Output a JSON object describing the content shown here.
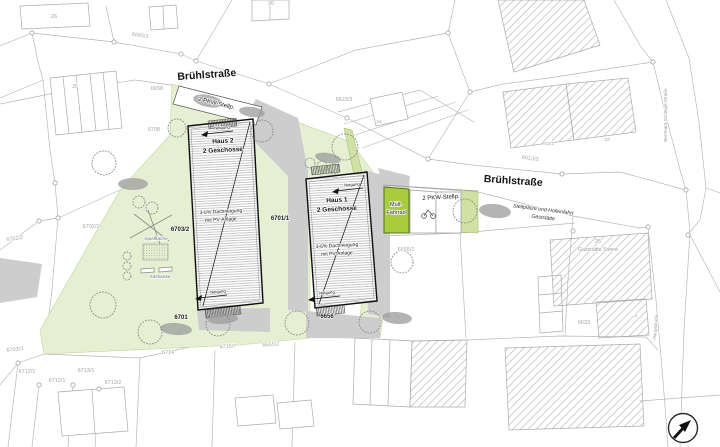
{
  "plan_type": "site-plan",
  "colors": {
    "site_green": "#e6efd2",
    "hedge_green": "#cfe2a4",
    "accent_green": "#a8cb40",
    "paved_gray": "#cdcdcd",
    "line_gray": "#b5b5b5",
    "text_dark": "#141414",
    "text_faint": "#a6a6a6"
  },
  "labels": [
    {
      "name": "building-26-left-label",
      "text": "26",
      "x": 54,
      "y": 18,
      "rot": 0,
      "size": 5.5,
      "weight": 400,
      "color": "#a6a6a6"
    },
    {
      "name": "building-26-top-label",
      "text": "26",
      "x": 271,
      "y": 5,
      "rot": 0,
      "size": 5.5,
      "weight": 400,
      "color": "#a6a6a6"
    },
    {
      "name": "parcel-6665-1",
      "text": "6665/1",
      "x": 140,
      "y": 37,
      "rot": 8,
      "size": 5.5,
      "weight": 400,
      "color": "#a6a6a6"
    },
    {
      "name": "street-bruehlstrasse-west",
      "text": "Brühlstraße",
      "x": 207,
      "y": 78,
      "rot": -4,
      "size": 10.5,
      "weight": 700,
      "color": "#141414"
    },
    {
      "name": "parcel-6658",
      "text": "6658",
      "x": 157,
      "y": 90,
      "rot": 0,
      "size": 5.5,
      "weight": 400,
      "color": "#a6a6a6"
    },
    {
      "name": "pkw-stellplatz-west-label",
      "text": "2 PKW-Stellp.",
      "x": 216,
      "y": 105,
      "rot": 14,
      "size": 6,
      "weight": 400,
      "color": "#141414"
    },
    {
      "name": "parcel-6708",
      "text": "6708",
      "x": 154,
      "y": 131,
      "rot": 0,
      "size": 5.5,
      "weight": 400,
      "color": "#a6a6a6"
    },
    {
      "name": "parcel-25-west",
      "text": "25",
      "x": 75,
      "y": 88,
      "rot": 0,
      "size": 5,
      "weight": 400,
      "color": "#a6a6a6"
    },
    {
      "name": "parcel-6623-3",
      "text": "6623/3",
      "x": 344,
      "y": 101,
      "rot": 0,
      "size": 5.5,
      "weight": 400,
      "color": "#a6a6a6"
    },
    {
      "name": "building-24-label",
      "text": "24",
      "x": 379,
      "y": 123,
      "rot": 0,
      "size": 4.8,
      "weight": 400,
      "color": "#a6a6a6"
    },
    {
      "name": "parcel-6613-3",
      "text": "6613/3",
      "x": 530,
      "y": 160,
      "rot": 8,
      "size": 5.5,
      "weight": 400,
      "color": "#a6a6a6"
    },
    {
      "name": "building-23-1-label",
      "text": "23/1",
      "x": 549,
      "y": 145,
      "rot": 0,
      "size": 4.8,
      "weight": 400,
      "color": "#a6a6a6"
    },
    {
      "name": "building-23-label",
      "text": "23",
      "x": 607,
      "y": 141,
      "rot": 0,
      "size": 4.8,
      "weight": 400,
      "color": "#a6a6a6"
    },
    {
      "name": "street-bruehlstrasse-east",
      "text": "Brühlstraße",
      "x": 513,
      "y": 184,
      "rot": 4,
      "size": 10.5,
      "weight": 700,
      "color": "#141414"
    },
    {
      "name": "street-bernhard-schlegel",
      "text": "Bernhard-Schlegel-Straße",
      "x": 667,
      "y": 115,
      "rot": -90,
      "size": 4.6,
      "weight": 400,
      "color": "#9a9a9a"
    },
    {
      "name": "note-stellplaetze-line1",
      "text": "Stellplätze und Hofeinfahrt",
      "x": 543,
      "y": 211,
      "rot": 7,
      "size": 5.2,
      "weight": 400,
      "color": "#333333",
      "italic": true
    },
    {
      "name": "note-stellplaetze-line2",
      "text": "Gaststätte",
      "x": 543,
      "y": 219,
      "rot": 7,
      "size": 5.2,
      "weight": 400,
      "color": "#333333",
      "italic": true
    },
    {
      "name": "gaststaette-number",
      "text": "25",
      "x": 598,
      "y": 243,
      "rot": 0,
      "size": 5,
      "weight": 400,
      "color": "#9a9a9a"
    },
    {
      "name": "gaststaette-name",
      "text": "Gaststätte Sonne",
      "x": 598,
      "y": 251,
      "rot": 0,
      "size": 5.2,
      "weight": 400,
      "color": "#9a9a9a"
    },
    {
      "name": "parcel-6633",
      "text": "6633",
      "x": 584,
      "y": 324,
      "rot": 0,
      "size": 5.5,
      "weight": 400,
      "color": "#a6a6a6"
    },
    {
      "name": "annex-2-label",
      "text": "2",
      "x": 636,
      "y": 317,
      "rot": 0,
      "size": 4.5,
      "weight": 400,
      "color": "#a6a6a6"
    },
    {
      "name": "street-hauptstrasse",
      "text": "Hauptstraße",
      "x": 657,
      "y": 327,
      "rot": -85,
      "size": 4.6,
      "weight": 400,
      "color": "#9a9a9a"
    },
    {
      "name": "parcel-6702-2",
      "text": "6702/2",
      "x": 15,
      "y": 240,
      "rot": -8,
      "size": 5.5,
      "weight": 400,
      "color": "#a6a6a6"
    },
    {
      "name": "parcel-6702-1",
      "text": "6702/1",
      "x": 91,
      "y": 228,
      "rot": 0,
      "size": 5.5,
      "weight": 400,
      "color": "#a6a6a6"
    },
    {
      "name": "parcel-6703-2",
      "text": "6703/2",
      "x": 180,
      "y": 231,
      "rot": 0,
      "size": 6,
      "weight": 700,
      "color": "#141414"
    },
    {
      "name": "haus2-name",
      "text": "Haus 2",
      "x": 223,
      "y": 143,
      "rot": -3,
      "size": 6.5,
      "weight": 700,
      "color": "#141414"
    },
    {
      "name": "haus2-floors",
      "text": "2 Geschosse",
      "x": 223,
      "y": 152,
      "rot": -3,
      "size": 6.5,
      "weight": 700,
      "color": "#141414"
    },
    {
      "name": "haus2-neigung-top",
      "text": "Neigung",
      "x": 222,
      "y": 129,
      "rot": -4,
      "size": 4.2,
      "weight": 400,
      "color": "#141414"
    },
    {
      "name": "haus2-roof-line1",
      "text": "3-6% Dachneigung",
      "x": 221,
      "y": 213,
      "rot": -3,
      "size": 5,
      "weight": 400,
      "color": "#141414"
    },
    {
      "name": "haus2-roof-line2",
      "text": "mit PV-Anlage",
      "x": 221,
      "y": 221,
      "rot": -3,
      "size": 5,
      "weight": 400,
      "color": "#141414"
    },
    {
      "name": "haus2-neigung-bottom",
      "text": "Neigung",
      "x": 218,
      "y": 293,
      "rot": -4,
      "size": 4.2,
      "weight": 400,
      "color": "#141414"
    },
    {
      "name": "playground-label",
      "text": "Spielfläche",
      "x": 156,
      "y": 240,
      "rot": 0,
      "size": 4.8,
      "weight": 400,
      "color": "#6e6e6e"
    },
    {
      "name": "benches-label",
      "text": "Sitzbänke",
      "x": 160,
      "y": 278,
      "rot": 0,
      "size": 4.8,
      "weight": 400,
      "color": "#6e6e6e"
    },
    {
      "name": "parcel-6701",
      "text": "6701",
      "x": 181,
      "y": 319,
      "rot": 0,
      "size": 6,
      "weight": 700,
      "color": "#141414"
    },
    {
      "name": "parcel-6701-1",
      "text": "6701/1",
      "x": 280,
      "y": 220,
      "rot": 0,
      "size": 6,
      "weight": 700,
      "color": "#141414"
    },
    {
      "name": "haus1-neigung-top",
      "text": "Neigung",
      "x": 352,
      "y": 186,
      "rot": -4,
      "size": 4.2,
      "weight": 400,
      "color": "#141414"
    },
    {
      "name": "haus1-name",
      "text": "Haus 1",
      "x": 337,
      "y": 202,
      "rot": -3,
      "size": 6.5,
      "weight": 700,
      "color": "#141414"
    },
    {
      "name": "haus1-floors",
      "text": "2 Geschosse",
      "x": 337,
      "y": 211,
      "rot": -3,
      "size": 6.5,
      "weight": 700,
      "color": "#141414"
    },
    {
      "name": "haus1-roof-line1",
      "text": "3-6% Dachneigung",
      "x": 337,
      "y": 247,
      "rot": -3,
      "size": 5,
      "weight": 400,
      "color": "#141414"
    },
    {
      "name": "haus1-roof-line2",
      "text": "mit PV-Anlage",
      "x": 337,
      "y": 255,
      "rot": -3,
      "size": 5,
      "weight": 400,
      "color": "#141414"
    },
    {
      "name": "haus1-neigung-bottom",
      "text": "Neigung",
      "x": 327,
      "y": 294,
      "rot": -4,
      "size": 4.2,
      "weight": 400,
      "color": "#141414"
    },
    {
      "name": "parcel-6656",
      "text": "6656",
      "x": 327,
      "y": 318,
      "rot": 0,
      "size": 6,
      "weight": 700,
      "color": "#141414"
    },
    {
      "name": "muell-box-line1",
      "text": "Müll-",
      "x": 396,
      "y": 206,
      "rot": 0,
      "size": 5.5,
      "weight": 400,
      "color": "#141414"
    },
    {
      "name": "muell-box-line2",
      "text": "Fahrrad",
      "x": 396,
      "y": 214,
      "rot": 0,
      "size": 5.5,
      "weight": 400,
      "color": "#141414"
    },
    {
      "name": "pkw-stellplatz-east-label",
      "text": "2 PKW-Stellp.",
      "x": 441,
      "y": 199,
      "rot": -3,
      "size": 6,
      "weight": 400,
      "color": "#141414"
    },
    {
      "name": "parcel-6655-1",
      "text": "6655/1",
      "x": 406,
      "y": 251,
      "rot": 0,
      "size": 5.5,
      "weight": 400,
      "color": "#a6a6a6"
    },
    {
      "name": "parcel-6655-2",
      "text": "6655/2",
      "x": 271,
      "y": 346,
      "rot": -5,
      "size": 5.5,
      "weight": 400,
      "color": "#a6a6a6"
    },
    {
      "name": "parcel-6703-3",
      "text": "6703/3",
      "x": 15,
      "y": 351,
      "rot": -5,
      "size": 5.5,
      "weight": 400,
      "color": "#a6a6a6"
    },
    {
      "name": "parcel-6712-1a",
      "text": "6712/1",
      "x": 27,
      "y": 373,
      "rot": 0,
      "size": 5.5,
      "weight": 400,
      "color": "#a6a6a6"
    },
    {
      "name": "parcel-6712-1b",
      "text": "6712/1",
      "x": 57,
      "y": 382,
      "rot": 0,
      "size": 5.5,
      "weight": 400,
      "color": "#a6a6a6"
    },
    {
      "name": "parcel-6713-1",
      "text": "6713/1",
      "x": 86,
      "y": 372,
      "rot": 0,
      "size": 5.5,
      "weight": 400,
      "color": "#a6a6a6"
    },
    {
      "name": "parcel-6713-2",
      "text": "6713/2",
      "x": 113,
      "y": 384,
      "rot": 0,
      "size": 5.5,
      "weight": 400,
      "color": "#a6a6a6"
    },
    {
      "name": "parcel-6714",
      "text": "6714",
      "x": 168,
      "y": 354,
      "rot": 0,
      "size": 5.5,
      "weight": 400,
      "color": "#a6a6a6"
    },
    {
      "name": "parcel-6715-7",
      "text": "6715/7",
      "x": 228,
      "y": 348,
      "rot": -3,
      "size": 5.5,
      "weight": 400,
      "color": "#a6a6a6"
    }
  ],
  "north_arrow": {
    "name": "north-arrow"
  }
}
